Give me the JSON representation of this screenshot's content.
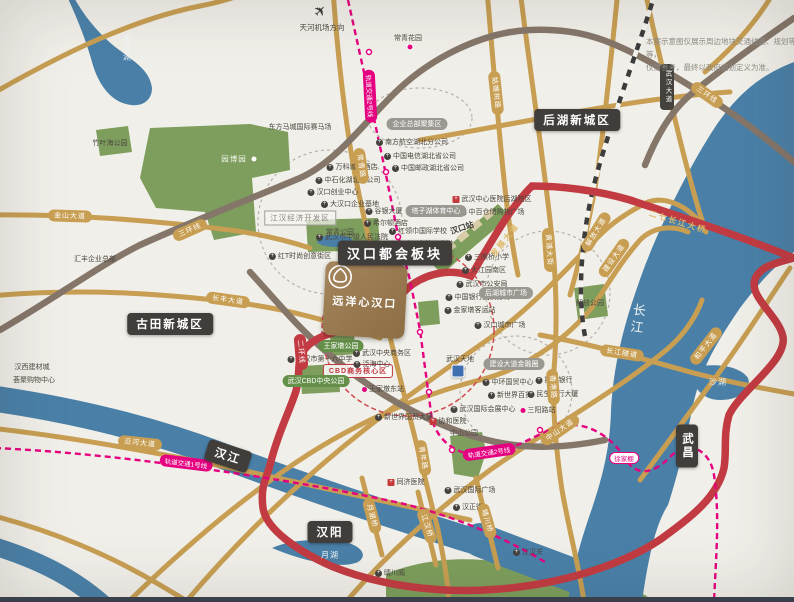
{
  "airport": {
    "label": "天河机场方向"
  },
  "note": {
    "line1": "本案示意图仅展示周边地块交通线路、规划等等，",
    "line2": "仅供参考，最终以政府规划定义为准。"
  },
  "project": {
    "name": "远洋心汉口"
  },
  "colors": {
    "background": "#f1efe9",
    "river": "#4a80a8",
    "park": "#7d9e5c",
    "gold_road": "#c79e52",
    "brown_road": "#85766a",
    "red_road": "#c23b42",
    "metro": "#e5007f",
    "label_dark": "#413d3b",
    "project_brown": "#97774e"
  },
  "map": {
    "labels": [
      {
        "k": "district big",
        "t": "汉口都会板块",
        "x": 395,
        "y": 253,
        "n": "district-label-hankou-metro"
      },
      {
        "k": "district",
        "t": "后湖新城区",
        "x": 577,
        "y": 120,
        "n": "district-label-houhu"
      },
      {
        "k": "district",
        "t": "古田新城区",
        "x": 170,
        "y": 324,
        "n": "district-label-gutian"
      },
      {
        "k": "district",
        "t": "汉阳",
        "x": 330,
        "y": 532,
        "n": "district-label-hanyang"
      },
      {
        "k": "district",
        "t": "武昌",
        "x": 687,
        "y": 446,
        "v": 1,
        "n": "district-label-wuchang"
      },
      {
        "k": "district",
        "t": "汉江",
        "x": 228,
        "y": 456,
        "r": 18,
        "n": "river-label-hanjiang"
      },
      {
        "k": "water big v",
        "t": "长江",
        "x": 637,
        "y": 320,
        "r": 8,
        "n": "river-label-yangtze"
      },
      {
        "k": "water v",
        "t": "金银湖",
        "x": 127,
        "y": 48,
        "n": "lake-label-jinyinhu"
      },
      {
        "k": "water",
        "t": "沙湖",
        "x": 718,
        "y": 382,
        "n": "lake-label-shahu"
      },
      {
        "k": "water",
        "t": "月湖",
        "x": 330,
        "y": 555,
        "n": "lake-label-yuehu"
      },
      {
        "k": "parkname",
        "t": "园博园",
        "x": 234,
        "y": 159,
        "n": "park-label-yuanboyuan"
      },
      {
        "k": "wdot",
        "x": 254,
        "y": 159,
        "n": "park-dot"
      },
      {
        "k": "poi",
        "t": "竹叶海公园",
        "x": 110,
        "y": 143
      },
      {
        "k": "poi",
        "t": "东方马城国际赛马场",
        "x": 300,
        "y": 127
      },
      {
        "k": "poi",
        "t": "汇丰企业总部",
        "x": 95,
        "y": 259
      },
      {
        "k": "poi",
        "t": "常青花园",
        "x": 408,
        "y": 38
      },
      {
        "k": "mdot",
        "x": 410,
        "y": 47,
        "n": "station-dot"
      },
      {
        "k": "graypill",
        "t": "企业总部聚集区",
        "x": 417,
        "y": 124
      },
      {
        "k": "poi",
        "t": "南方航空湖北分公司",
        "x": 412,
        "y": 142,
        "ic": "p"
      },
      {
        "k": "poi",
        "t": "中国电信湖北省公司",
        "x": 420,
        "y": 156,
        "ic": "p"
      },
      {
        "k": "poi",
        "t": "中国邮政湖北省公司",
        "x": 428,
        "y": 168,
        "ic": "p"
      },
      {
        "k": "poi",
        "t": "万科城市酒店",
        "x": 352,
        "y": 167,
        "ic": "p"
      },
      {
        "k": "poi",
        "t": "中石化湖北省公司",
        "x": 348,
        "y": 180,
        "ic": "p"
      },
      {
        "k": "poi",
        "t": "汉口创业中心",
        "x": 333,
        "y": 192,
        "ic": "p"
      },
      {
        "k": "poi",
        "t": "大汉口企业基地",
        "x": 350,
        "y": 204,
        "ic": "p"
      },
      {
        "k": "zonebox",
        "t": "江汉经济开发区",
        "x": 300,
        "y": 218
      },
      {
        "k": "poi",
        "t": "谷银大厦",
        "x": 384,
        "y": 211,
        "ic": "p"
      },
      {
        "k": "poi",
        "t": "希尔顿酒店",
        "x": 386,
        "y": 223,
        "ic": "p"
      },
      {
        "k": "poi",
        "t": "武汉市中级人民法院",
        "x": 352,
        "y": 237,
        "ic": "p"
      },
      {
        "k": "poi",
        "t": "红T时尚创意街区",
        "x": 300,
        "y": 256,
        "ic": "p"
      },
      {
        "k": "poi",
        "t": "常青公园",
        "x": 340,
        "y": 232
      },
      {
        "k": "poi",
        "t": "红领巾国际学校",
        "x": 418,
        "y": 231,
        "ic": "p"
      },
      {
        "k": "poi",
        "t": "武汉市第一中学",
        "x": 424,
        "y": 244,
        "ic": "p"
      },
      {
        "k": "poi bold",
        "t": "汉口站",
        "x": 462,
        "y": 228,
        "r": -18
      },
      {
        "k": "poi",
        "t": "武汉中心医院后湖院区",
        "x": 492,
        "y": 199,
        "ic": "h"
      },
      {
        "k": "poi",
        "t": "中百仓储购物广场",
        "x": 492,
        "y": 212,
        "ic": "p"
      },
      {
        "k": "graypill",
        "t": "塔子湖体育中心",
        "x": 436,
        "y": 211
      },
      {
        "k": "poi",
        "t": "三眼桥小学",
        "x": 487,
        "y": 257,
        "ic": "p"
      },
      {
        "k": "poi",
        "t": "大江园南区",
        "x": 484,
        "y": 270,
        "ic": "p"
      },
      {
        "k": "poi",
        "t": "武汉市公安局",
        "x": 482,
        "y": 284,
        "ic": "p"
      },
      {
        "k": "poi",
        "t": "中国银行武汉分行",
        "x": 478,
        "y": 297,
        "ic": "p"
      },
      {
        "k": "poi",
        "t": "金家墩客运站",
        "x": 470,
        "y": 310,
        "ic": "p"
      },
      {
        "k": "graypill",
        "t": "后湖城市广场",
        "x": 506,
        "y": 293
      },
      {
        "k": "poi",
        "t": "汉口城市广场",
        "x": 500,
        "y": 325,
        "ic": "p"
      },
      {
        "k": "poi",
        "t": "武汉天地",
        "x": 460,
        "y": 359
      },
      {
        "k": "blueicon",
        "x": 458,
        "y": 371,
        "n": "landmark-icon-wuhantiandi"
      },
      {
        "k": "poi",
        "t": "解放公园",
        "x": 590,
        "y": 303
      },
      {
        "k": "graypill",
        "t": "建设大道金融圈",
        "x": 514,
        "y": 364
      },
      {
        "k": "poi",
        "t": "中环国贸中心",
        "x": 508,
        "y": 382,
        "ic": "p"
      },
      {
        "k": "poi",
        "t": "招商银行",
        "x": 554,
        "y": 380,
        "ic": "p"
      },
      {
        "k": "poi",
        "t": "新世界百货",
        "x": 510,
        "y": 395,
        "ic": "p"
      },
      {
        "k": "poi",
        "t": "民生银行大厦",
        "x": 553,
        "y": 394,
        "ic": "p"
      },
      {
        "k": "poi",
        "t": "武汉国际会展中心",
        "x": 483,
        "y": 409,
        "ic": "p"
      },
      {
        "k": "cbdpill",
        "t": "CBD商务核心区",
        "x": 358,
        "y": 371
      },
      {
        "k": "greenpill",
        "t": "王家墩公园",
        "x": 341,
        "y": 346
      },
      {
        "k": "greenpill",
        "t": "武汉CBD中央公园",
        "x": 316,
        "y": 381
      },
      {
        "k": "poi",
        "t": "武汉市第十六中学",
        "x": 320,
        "y": 359,
        "ic": "p"
      },
      {
        "k": "poi",
        "t": "武汉中央商务区",
        "x": 382,
        "y": 353,
        "ic": "p"
      },
      {
        "k": "poi",
        "t": "泛海中心",
        "x": 372,
        "y": 364,
        "ic": "p"
      },
      {
        "k": "poi",
        "t": "王家墩东站",
        "x": 383,
        "y": 389,
        "ic": "m"
      },
      {
        "k": "poi",
        "t": "新世界国贸大厦",
        "x": 404,
        "y": 417,
        "ic": "p"
      },
      {
        "k": "poi",
        "t": "协和医院",
        "x": 448,
        "y": 421,
        "ic": "h"
      },
      {
        "k": "poi",
        "t": "中山公园",
        "x": 464,
        "y": 433
      },
      {
        "k": "poi",
        "t": "同济医院",
        "x": 406,
        "y": 482,
        "ic": "h"
      },
      {
        "k": "poi",
        "t": "武汉国际广场",
        "x": 470,
        "y": 490,
        "ic": "p"
      },
      {
        "k": "poi",
        "t": "汉正街",
        "x": 468,
        "y": 507,
        "ic": "p"
      },
      {
        "k": "poi",
        "t": "江汉关",
        "x": 528,
        "y": 552,
        "ic": "p"
      },
      {
        "k": "poi",
        "t": "晴川阁",
        "x": 390,
        "y": 573,
        "ic": "p"
      },
      {
        "k": "poi",
        "t": "汉西建材城",
        "x": 32,
        "y": 367
      },
      {
        "k": "poi",
        "t": "荟聚购物中心",
        "x": 34,
        "y": 380
      },
      {
        "k": "poi",
        "t": "三阳路站",
        "x": 538,
        "y": 410,
        "ic": "m"
      },
      {
        "k": "stationpill",
        "t": "徐家棚",
        "x": 624,
        "y": 458
      },
      {
        "k": "goldpill",
        "t": "三环线",
        "x": 190,
        "y": 230,
        "r": -24
      },
      {
        "k": "goldpill",
        "t": "三环线",
        "x": 707,
        "y": 95,
        "r": 35
      },
      {
        "k": "goldpill",
        "t": "金山大道",
        "x": 70,
        "y": 216,
        "r": 2
      },
      {
        "k": "goldpill",
        "t": "长丰大道",
        "x": 228,
        "y": 300,
        "r": 8
      },
      {
        "k": "goldpill",
        "t": "常青路",
        "x": 361,
        "y": 166,
        "r": 82
      },
      {
        "k": "goldpill",
        "t": "青年路",
        "x": 423,
        "y": 458,
        "r": 80
      },
      {
        "k": "goldpill",
        "t": "解放大道",
        "x": 596,
        "y": 232,
        "r": -58
      },
      {
        "k": "goldpill",
        "t": "建设大道",
        "x": 614,
        "y": 258,
        "r": -55
      },
      {
        "k": "goldpill",
        "t": "姑嫂树路",
        "x": 496,
        "y": 93,
        "r": 84
      },
      {
        "k": "goldpill",
        "t": "黄浦大街",
        "x": 549,
        "y": 250,
        "r": 86
      },
      {
        "k": "goldpill",
        "t": "香港路",
        "x": 553,
        "y": 387,
        "r": 86
      },
      {
        "k": "goldpill",
        "t": "和平大道",
        "x": 706,
        "y": 346,
        "r": -52
      },
      {
        "k": "goldpill",
        "t": "长江隧道",
        "x": 622,
        "y": 353,
        "r": 9
      },
      {
        "k": "goldpill",
        "t": "中山大道",
        "x": 560,
        "y": 430,
        "r": -35
      },
      {
        "k": "goldpill",
        "t": "沿河大道",
        "x": 140,
        "y": 443,
        "r": 6
      },
      {
        "k": "goldpill",
        "t": "月湖桥",
        "x": 372,
        "y": 516,
        "r": 75
      },
      {
        "k": "goldpill",
        "t": "江汉桥",
        "x": 427,
        "y": 526,
        "r": 72
      },
      {
        "k": "goldpill",
        "t": "晴川桥",
        "x": 487,
        "y": 521,
        "r": 74
      },
      {
        "k": "redpill",
        "t": "二环线",
        "x": 301,
        "y": 352,
        "r": 85
      },
      {
        "k": "goldtext",
        "t": "发展大道",
        "x": 385,
        "y": 309,
        "r": -60
      },
      {
        "k": "goldtext",
        "t": "发展大道",
        "x": 505,
        "y": 240,
        "r": -52
      },
      {
        "k": "goldtext",
        "t": "二七长江大桥",
        "x": 678,
        "y": 222,
        "r": 17
      },
      {
        "k": "metropill",
        "t": "轨道交通2号线",
        "x": 370,
        "y": 96,
        "r": 87
      },
      {
        "k": "metropill",
        "t": "轨道交通2号线",
        "x": 489,
        "y": 452,
        "r": -8
      },
      {
        "k": "metropill",
        "t": "轨道交通1号线",
        "x": 186,
        "y": 463,
        "r": 7
      },
      {
        "k": "darkpill v",
        "t": "武汉大道",
        "x": 667,
        "y": 87,
        "n": "road-label-dark"
      }
    ]
  }
}
